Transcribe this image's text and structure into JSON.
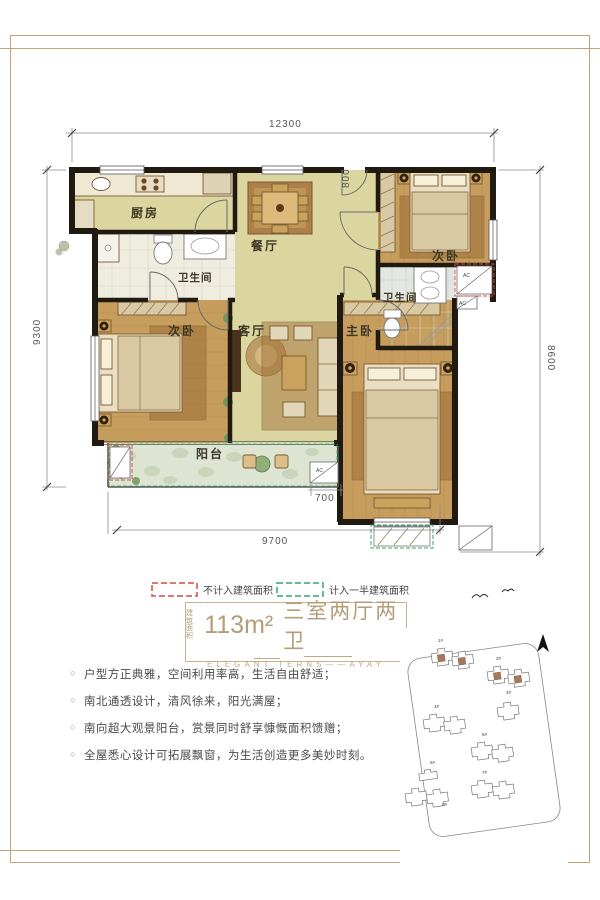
{
  "page": {
    "bg": "#ffffff",
    "frame_color": "#c5a179"
  },
  "plan": {
    "rooms": {
      "kitchen": "厨房",
      "dining": "餐厅",
      "bedroom_top": "次卧",
      "bath_main": "卫生间",
      "living": "客厅",
      "bedroom_left": "次卧",
      "master": "主卧",
      "bath_master": "卫生间",
      "balcony": "阳台"
    },
    "dims": {
      "top": "12300",
      "left": "9300",
      "right": "8600",
      "bottom": "9700",
      "step": "700",
      "entry": "800"
    },
    "ac": "AC"
  },
  "legend": {
    "excluded": {
      "label": "不计入建筑面积",
      "color": "#d94a43"
    },
    "half": {
      "label": "计入一半建筑面积",
      "color": "#2fa86d"
    }
  },
  "title": {
    "small_1": "建筑",
    "small_2": "面积",
    "area": "113m²",
    "rooms": "三室两厅两卫",
    "subtitle": "ELEGANT TERNS——AYAY"
  },
  "features": {
    "bullet": "○",
    "items": [
      "户型方正典雅，空间利用率高，生活自由舒适；",
      "南北通透设计，清风徐来，阳光满屋；",
      "南向超大观景阳台，赏景同时舒享慷慨面积馈赠；",
      "全屋悉心设计可拓展飘窗，为生活创造更多美妙时刻。"
    ]
  },
  "site_map": {
    "buildings": [
      "1#",
      "2#",
      "3#",
      "4#",
      "5#",
      "6#",
      "7#",
      "8#"
    ]
  }
}
